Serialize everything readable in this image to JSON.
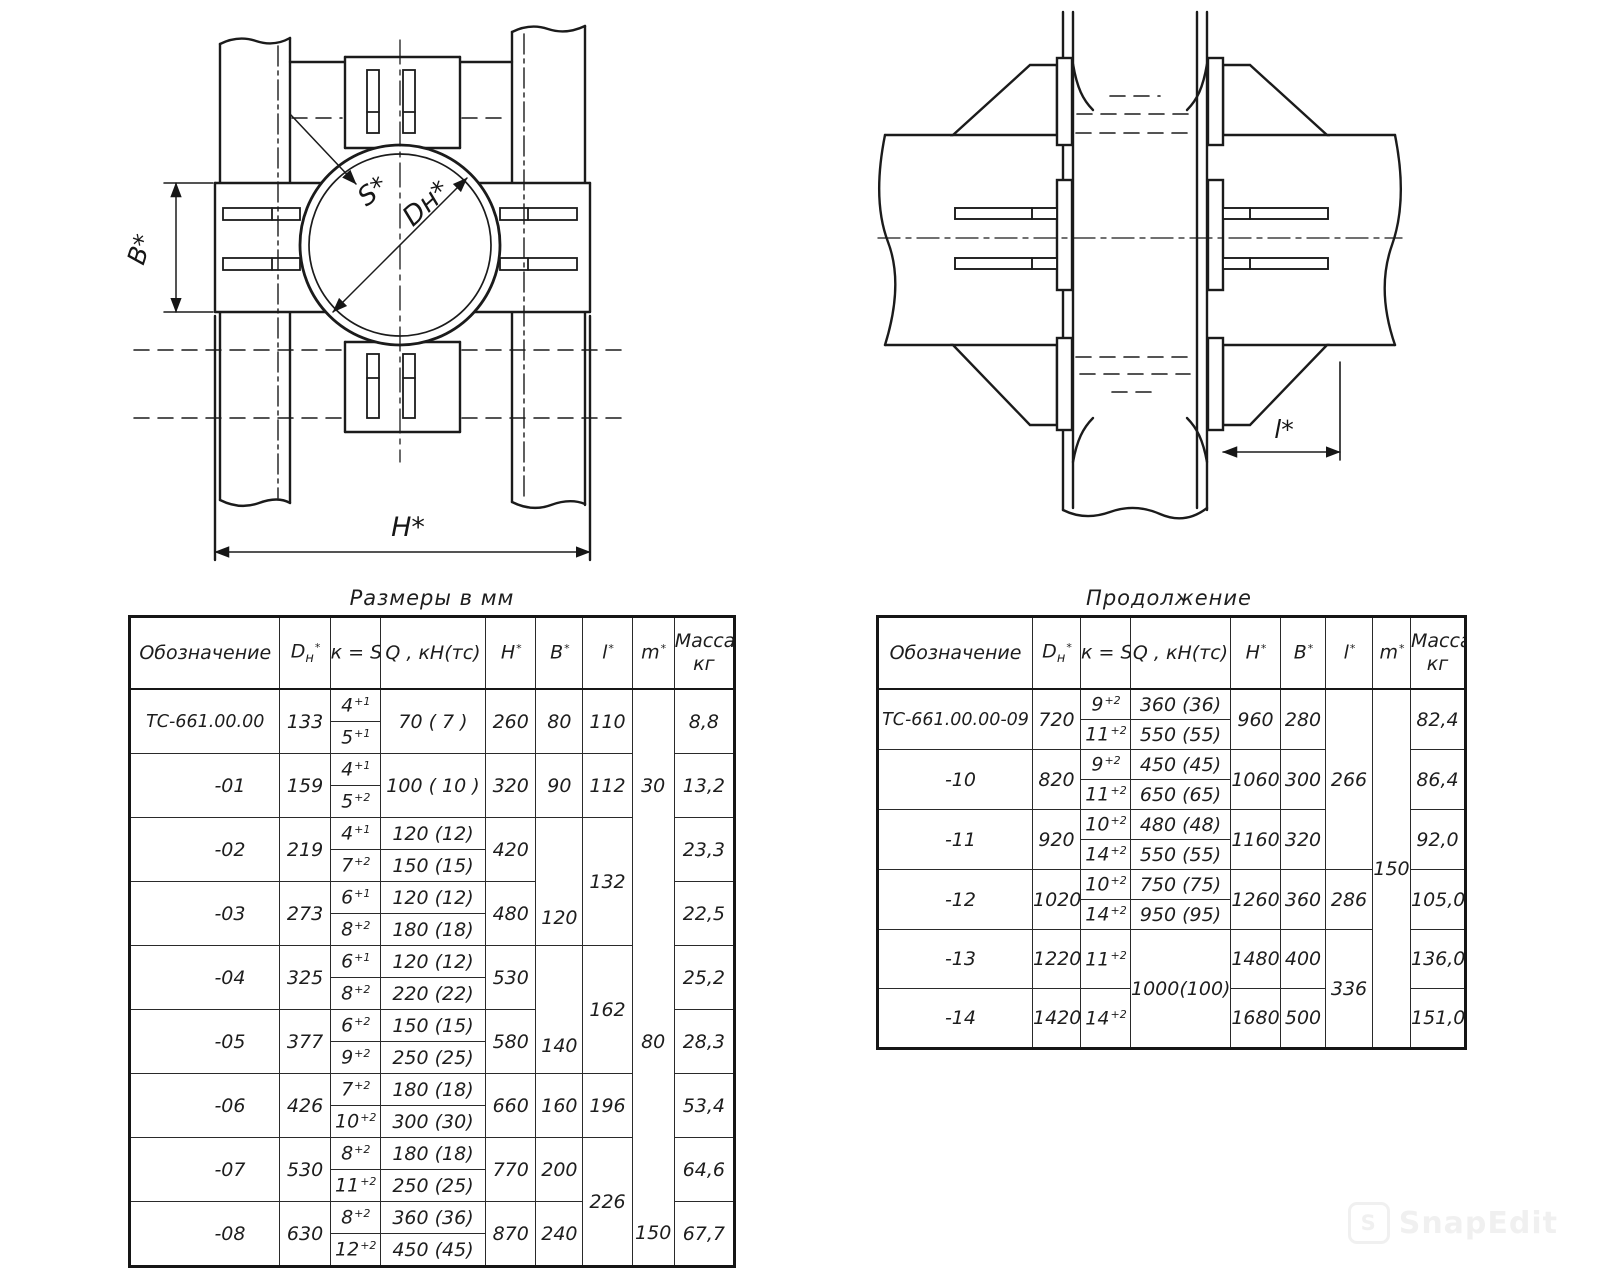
{
  "watermark": {
    "text": "SnapEdit",
    "logo_letter": "S"
  },
  "drawings": {
    "plan_view": {
      "labels": {
        "wall_thickness": "S*",
        "outer_diameter": "Dн*",
        "clamp_width": "B*",
        "overall_width": "H*"
      }
    },
    "side_view": {
      "labels": {
        "bracket_length": "l*"
      }
    }
  },
  "tables": {
    "left": {
      "title": "Размеры в мм",
      "col_widths": [
        150,
        50,
        50,
        105,
        50,
        47,
        49,
        42,
        60
      ],
      "header": [
        {
          "t": "Обозначение"
        },
        {
          "t": "D",
          "sub": "н",
          "sup": "*"
        },
        {
          "t": "к = S",
          "sup": "*"
        },
        {
          "t": "Q , кН(тс)"
        },
        {
          "t": "Н",
          "sup": "*"
        },
        {
          "t": "В",
          "sup": "*"
        },
        {
          "t": "l",
          "sup": "*"
        },
        {
          "t": "m",
          "sup": "*"
        },
        {
          "t": "Масса,",
          "t2": "кг"
        }
      ],
      "rows": [
        [
          {
            "t": "ТС-661.00.00",
            "rs": 2,
            "c": "full"
          },
          {
            "t": "133",
            "rs": 2
          },
          {
            "t": "4",
            "sup": "+1"
          },
          {
            "t": "70  ( 7 )",
            "rs": 2
          },
          {
            "t": "260",
            "rs": 2
          },
          {
            "t": "80",
            "rs": 2
          },
          {
            "t": "110",
            "rs": 2
          },
          {
            "t": "",
            "rs": 2,
            "c": "ml"
          },
          {
            "t": "8,8",
            "rs": 2
          }
        ],
        [
          {
            "t": "5",
            "sup": "+1"
          }
        ],
        [
          {
            "t": "-01",
            "rs": 2,
            "c": "dr"
          },
          {
            "t": "159",
            "rs": 2
          },
          {
            "t": "4",
            "sup": "+1"
          },
          {
            "t": "100 ( 10 )",
            "rs": 2
          },
          {
            "t": "320",
            "rs": 2
          },
          {
            "t": "90",
            "rs": 2
          },
          {
            "t": "112",
            "rs": 2
          },
          {
            "t": "30",
            "rs": 2,
            "c": "ml"
          },
          {
            "t": "13,2",
            "rs": 2
          }
        ],
        [
          {
            "t": "5",
            "sup": "+2"
          }
        ],
        [
          {
            "t": "-02",
            "rs": 2,
            "c": "dr"
          },
          {
            "t": "219",
            "rs": 2
          },
          {
            "t": "4",
            "sup": "+1"
          },
          {
            "t": "120 (12)"
          },
          {
            "t": "420",
            "rs": 2
          },
          {
            "t": "120",
            "rs": 4,
            "c": "vb"
          },
          {
            "t": "132",
            "rs": 4
          },
          {
            "t": "",
            "rs": 2,
            "c": "ml"
          },
          {
            "t": "23,3",
            "rs": 2
          }
        ],
        [
          {
            "t": "7",
            "sup": "+2"
          },
          {
            "t": "150 (15)"
          }
        ],
        [
          {
            "t": "-03",
            "rs": 2,
            "c": "dr"
          },
          {
            "t": "273",
            "rs": 2
          },
          {
            "t": "6",
            "sup": "+1"
          },
          {
            "t": "120 (12)"
          },
          {
            "t": "480",
            "rs": 2
          },
          {
            "t": "",
            "rs": 2,
            "c": "ml"
          },
          {
            "t": "22,5",
            "rs": 2
          }
        ],
        [
          {
            "t": "8",
            "sup": "+2"
          },
          {
            "t": "180 (18)"
          }
        ],
        [
          {
            "t": "-04",
            "rs": 2,
            "c": "dr"
          },
          {
            "t": "325",
            "rs": 2
          },
          {
            "t": "6",
            "sup": "+1"
          },
          {
            "t": "120 (12)"
          },
          {
            "t": "530",
            "rs": 2
          },
          {
            "t": "140",
            "rs": 4,
            "c": "vb"
          },
          {
            "t": "162",
            "rs": 4
          },
          {
            "t": "",
            "rs": 2,
            "c": "ml"
          },
          {
            "t": "25,2",
            "rs": 2
          }
        ],
        [
          {
            "t": "8",
            "sup": "+2"
          },
          {
            "t": "220 (22)"
          }
        ],
        [
          {
            "t": "-05",
            "rs": 2,
            "c": "dr"
          },
          {
            "t": "377",
            "rs": 2
          },
          {
            "t": "6",
            "sup": "+2"
          },
          {
            "t": "150 (15)"
          },
          {
            "t": "580",
            "rs": 2
          },
          {
            "t": "80",
            "rs": 2,
            "c": "ml"
          },
          {
            "t": "28,3",
            "rs": 2
          }
        ],
        [
          {
            "t": "9",
            "sup": "+2"
          },
          {
            "t": "250 (25)"
          }
        ],
        [
          {
            "t": "-06",
            "rs": 2,
            "c": "dr"
          },
          {
            "t": "426",
            "rs": 2
          },
          {
            "t": "7",
            "sup": "+2"
          },
          {
            "t": "180 (18)"
          },
          {
            "t": "660",
            "rs": 2
          },
          {
            "t": "160",
            "rs": 2
          },
          {
            "t": "196",
            "rs": 2
          },
          {
            "t": "",
            "rs": 2,
            "c": "ml"
          },
          {
            "t": "53,4",
            "rs": 2
          }
        ],
        [
          {
            "t": "10",
            "sup": "+2"
          },
          {
            "t": "300 (30)"
          }
        ],
        [
          {
            "t": "-07",
            "rs": 2,
            "c": "dr"
          },
          {
            "t": "530",
            "rs": 2
          },
          {
            "t": "8",
            "sup": "+2"
          },
          {
            "t": "180 (18)"
          },
          {
            "t": "770",
            "rs": 2
          },
          {
            "t": "200",
            "rs": 2
          },
          {
            "t": "226",
            "rs": 4
          },
          {
            "t": "",
            "rs": 2,
            "c": "ml"
          },
          {
            "t": "64,6",
            "rs": 2
          }
        ],
        [
          {
            "t": "11",
            "sup": "+2"
          },
          {
            "t": "250 (25)"
          }
        ],
        [
          {
            "t": "-08",
            "rs": 2,
            "c": "dr"
          },
          {
            "t": "630",
            "rs": 2
          },
          {
            "t": "8",
            "sup": "+2"
          },
          {
            "t": "360 (36)"
          },
          {
            "t": "870",
            "rs": 2
          },
          {
            "t": "240",
            "rs": 2
          },
          {
            "t": "150",
            "rs": 2,
            "c": "ml"
          },
          {
            "t": "67,7",
            "rs": 2
          }
        ],
        [
          {
            "t": "12",
            "sup": "+2"
          },
          {
            "t": "450 (45)"
          }
        ]
      ]
    },
    "right": {
      "title": "Продолжение",
      "col_widths": [
        155,
        48,
        50,
        100,
        50,
        45,
        47,
        38,
        55
      ],
      "header": [
        {
          "t": "Обозначение"
        },
        {
          "t": "D",
          "sub": "н",
          "sup": "*"
        },
        {
          "t": "к = S",
          "sup": "*"
        },
        {
          "t": "Q , кН(тс)"
        },
        {
          "t": "Н",
          "sup": "*"
        },
        {
          "t": "В",
          "sup": "*"
        },
        {
          "t": "l",
          "sup": "*"
        },
        {
          "t": "m",
          "sup": "*"
        },
        {
          "t": "Масса,",
          "t2": "кг"
        }
      ],
      "rows": [
        [
          {
            "t": "ТС-661.00.00-09",
            "rs": 2,
            "c": "full"
          },
          {
            "t": "720",
            "rs": 2
          },
          {
            "t": "9",
            "sup": "+2"
          },
          {
            "t": "360 (36)"
          },
          {
            "t": "960",
            "rs": 2
          },
          {
            "t": "280",
            "rs": 2
          },
          {
            "t": "266",
            "rs": 6
          },
          {
            "t": "150",
            "rs": 10
          },
          {
            "t": "82,4",
            "rs": 2
          }
        ],
        [
          {
            "t": "11",
            "sup": "+2"
          },
          {
            "t": "550 (55)"
          }
        ],
        [
          {
            "t": "-10",
            "rs": 2,
            "c": "dr"
          },
          {
            "t": "820",
            "rs": 2
          },
          {
            "t": "9",
            "sup": "+2"
          },
          {
            "t": "450 (45)"
          },
          {
            "t": "1060",
            "rs": 2
          },
          {
            "t": "300",
            "rs": 2
          },
          {
            "t": "86,4",
            "rs": 2
          }
        ],
        [
          {
            "t": "11",
            "sup": "+2"
          },
          {
            "t": "650 (65)"
          }
        ],
        [
          {
            "t": "-11",
            "rs": 2,
            "c": "dr"
          },
          {
            "t": "920",
            "rs": 2
          },
          {
            "t": "10",
            "sup": "+2"
          },
          {
            "t": "480 (48)"
          },
          {
            "t": "1160",
            "rs": 2
          },
          {
            "t": "320",
            "rs": 2
          },
          {
            "t": "92,0",
            "rs": 2
          }
        ],
        [
          {
            "t": "14",
            "sup": "+2"
          },
          {
            "t": "550 (55)"
          }
        ],
        [
          {
            "t": "-12",
            "rs": 2,
            "c": "dr"
          },
          {
            "t": "1020",
            "rs": 2
          },
          {
            "t": "10",
            "sup": "+2"
          },
          {
            "t": "750 (75)"
          },
          {
            "t": "1260",
            "rs": 2
          },
          {
            "t": "360",
            "rs": 2
          },
          {
            "t": "286",
            "rs": 2
          },
          {
            "t": "105,0",
            "rs": 2
          }
        ],
        [
          {
            "t": "14",
            "sup": "+2"
          },
          {
            "t": "950 (95)"
          }
        ],
        [
          {
            "t": "-13",
            "c": "dr tall"
          },
          {
            "t": "1220",
            "c": "tall"
          },
          {
            "t": "11",
            "sup": "+2",
            "c": "tall"
          },
          {
            "t": "1000(100)",
            "rs": 2
          },
          {
            "t": "1480",
            "c": "tall"
          },
          {
            "t": "400",
            "c": "tall"
          },
          {
            "t": "336",
            "rs": 2
          },
          {
            "t": "136,0",
            "c": "tall"
          }
        ],
        [
          {
            "t": "-14",
            "c": "dr tall"
          },
          {
            "t": "1420",
            "c": "tall"
          },
          {
            "t": "14",
            "sup": "+2",
            "c": "tall"
          },
          {
            "t": "1680",
            "c": "tall"
          },
          {
            "t": "500",
            "c": "tall"
          },
          {
            "t": "151,0",
            "c": "tall"
          }
        ]
      ]
    }
  }
}
